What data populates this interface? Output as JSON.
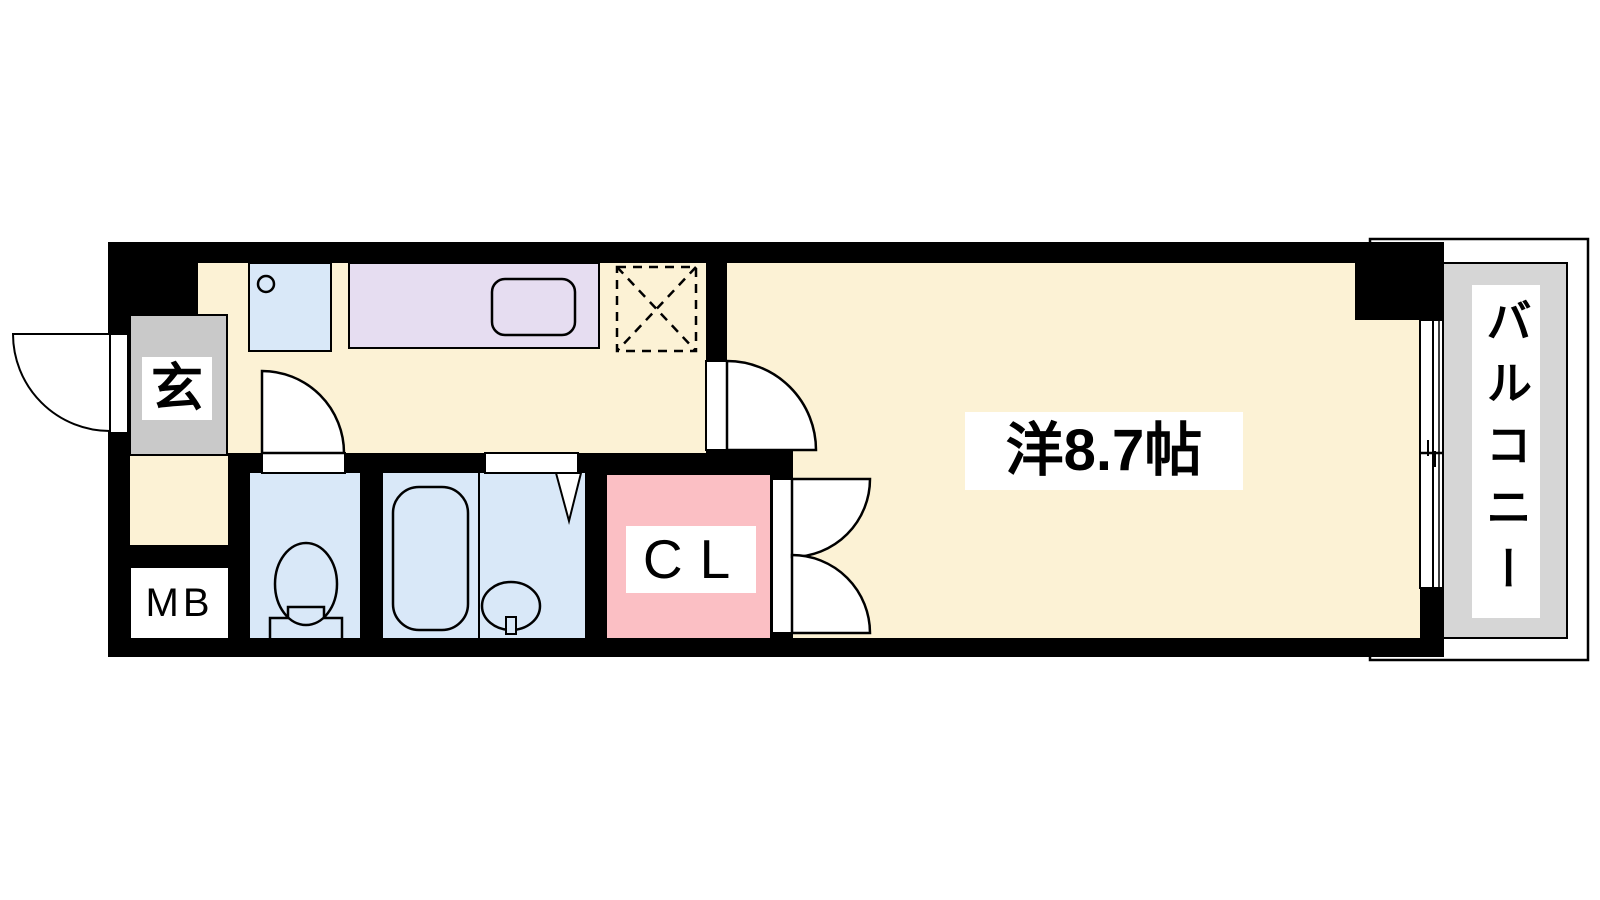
{
  "plan": {
    "rooms": {
      "entrance": {
        "label": "玄"
      },
      "meter_box": {
        "label": "MB"
      },
      "closet": {
        "label": "CL"
      },
      "western_room": {
        "label": "洋8.7帖"
      },
      "balcony": {
        "label": "バルコニー"
      }
    },
    "colors": {
      "wall_black": "#000000",
      "floor_cream": "#fcf2d5",
      "water_blue": "#d9e8f8",
      "counter_purple": "#e6ddf1",
      "closet_pink": "#fbbfc4",
      "entrance_gray": "#c9c9c9",
      "balcony_gray": "#d6d6d6",
      "label_bg": "#ffffff",
      "opening_white": "#ffffff"
    }
  }
}
